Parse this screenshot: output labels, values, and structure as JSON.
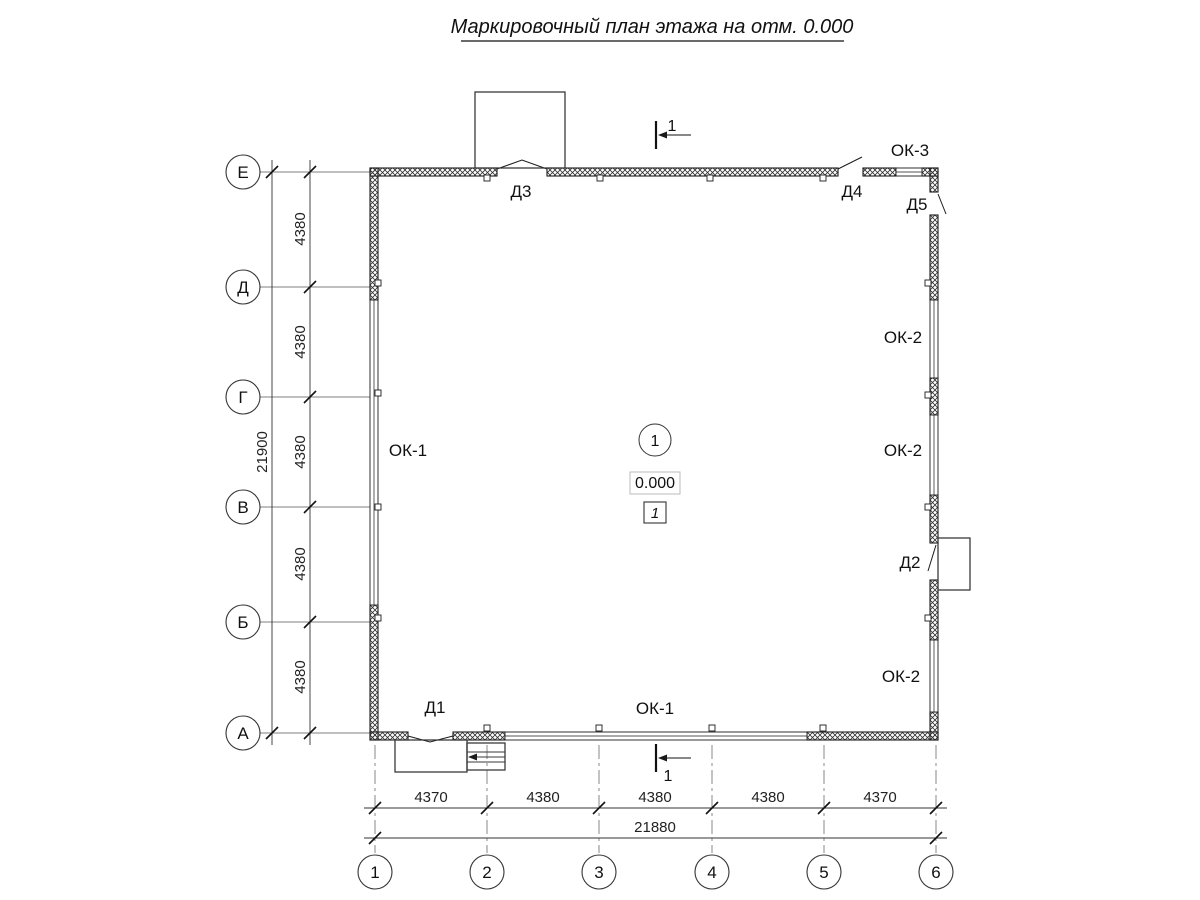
{
  "title": "Маркировочный план этажа на отм. 0.000",
  "grid": {
    "rows": [
      "Е",
      "Д",
      "Г",
      "В",
      "Б",
      "А"
    ],
    "cols": [
      "1",
      "2",
      "3",
      "4",
      "5",
      "6"
    ]
  },
  "dims": {
    "left_segments": [
      "4380",
      "4380",
      "4380",
      "4380",
      "4380"
    ],
    "left_total": "21900",
    "bottom_segments": [
      "4370",
      "4380",
      "4380",
      "4380",
      "4370"
    ],
    "bottom_total": "21880"
  },
  "labels": {
    "d1": "Д1",
    "d2": "Д2",
    "d3": "Д3",
    "d4": "Д4",
    "d5": "Д5",
    "ok1_left": "ОК-1",
    "ok1_bottom": "ОК-1",
    "ok2_top": "ОК-2",
    "ok2_middle": "ОК-2",
    "ok2_bottom": "ОК-2",
    "ok3": "ОК-3"
  },
  "room": {
    "marker": "1",
    "elevation": "0.000",
    "number": "1"
  },
  "section": {
    "top": "1",
    "bottom": "1"
  }
}
